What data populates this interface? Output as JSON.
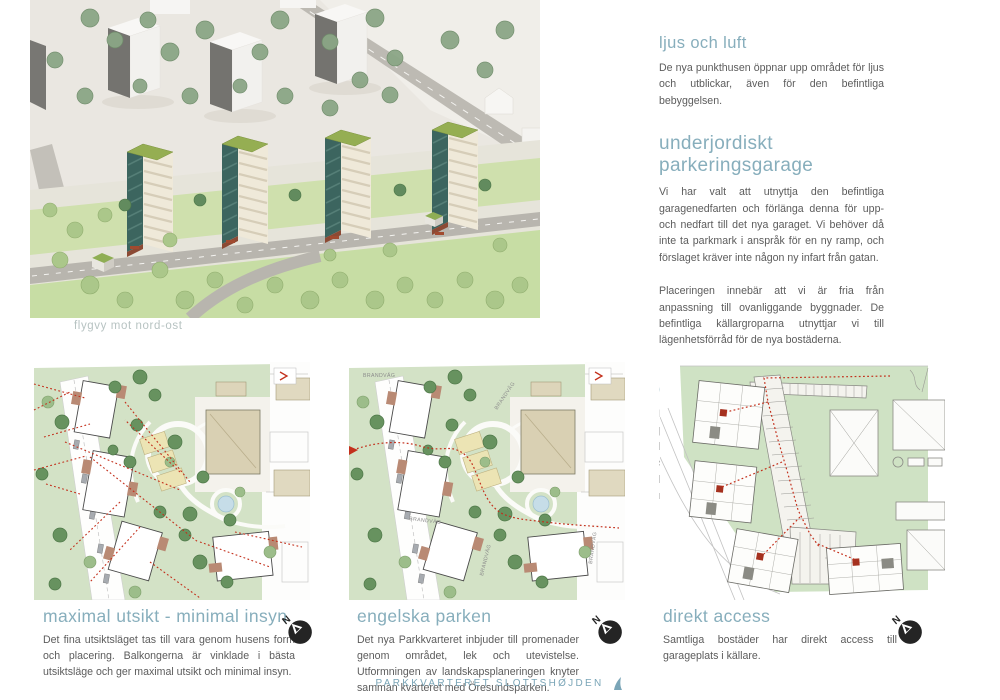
{
  "hero": {
    "caption": "flygvy mot nord-ost"
  },
  "sections": [
    {
      "heading": "ljus och luft",
      "paragraphs": [
        "De nya punkthusen öppnar upp området för ljus och utblickar, även för den befintliga bebyggelsen."
      ]
    },
    {
      "heading": "underjordiskt parkeringsgarage",
      "paragraphs": [
        "Vi har valt att utnyttja den befintliga garagenedfarten och förlänga denna för upp- och nedfart till det nya garaget. Vi behöver då inte ta parkmark i anspråk för en ny ramp, och förslaget kräver inte någon ny infart från gatan.",
        "Placeringen innebär att vi är fria från anpassning till ovanliggande byggnader. De befintliga källargroparna utnyttjar vi till lägenhetsförråd för de nya bostäderna."
      ]
    },
    {
      "heading": "gröna tak",
      "paragraphs": [
        "De små fristående husen för restavfall är placerade lite som grindstugor utmed gatan. De byggs av betongelement som avfärgas med silikatfärg i kulör samstämda med bostadshusen. Taken är \"gröna tak\" belagda med sedum."
      ]
    }
  ],
  "plans": [
    {
      "heading": "maximal utsikt - minimal insyn",
      "body": "Det fina utsiktsläget tas till vara genom husens form och placering. Balkongerna är vinklade i bästa utsiktsläge och ger maximal utsikt och minimal insyn."
    },
    {
      "heading": "engelska parken",
      "body": "Det nya Parkkvarteret inbjuder till promenader genom området, lek och utevistelse. Utformningen av landskapsplaneringen knyter samman kvarteret med Öresundsparken.",
      "map_label": "BRANDVÄG"
    },
    {
      "heading": "direkt access",
      "body": "Samtliga bostäder har direkt access till garageplats i källare."
    }
  ],
  "compass": {
    "label": "N"
  },
  "footer": {
    "brand": "PARKKVARTERET SLOTTSHØJDEN"
  },
  "colors": {
    "accent_teal": "#87aebc",
    "caption_gray": "#b7c3c2",
    "body_text": "#5c5c5c",
    "route_red": "#c3301c",
    "facade_teal": "#3c655f",
    "roof_green": "#95ae52",
    "plan_green": "#d3e2c6"
  }
}
